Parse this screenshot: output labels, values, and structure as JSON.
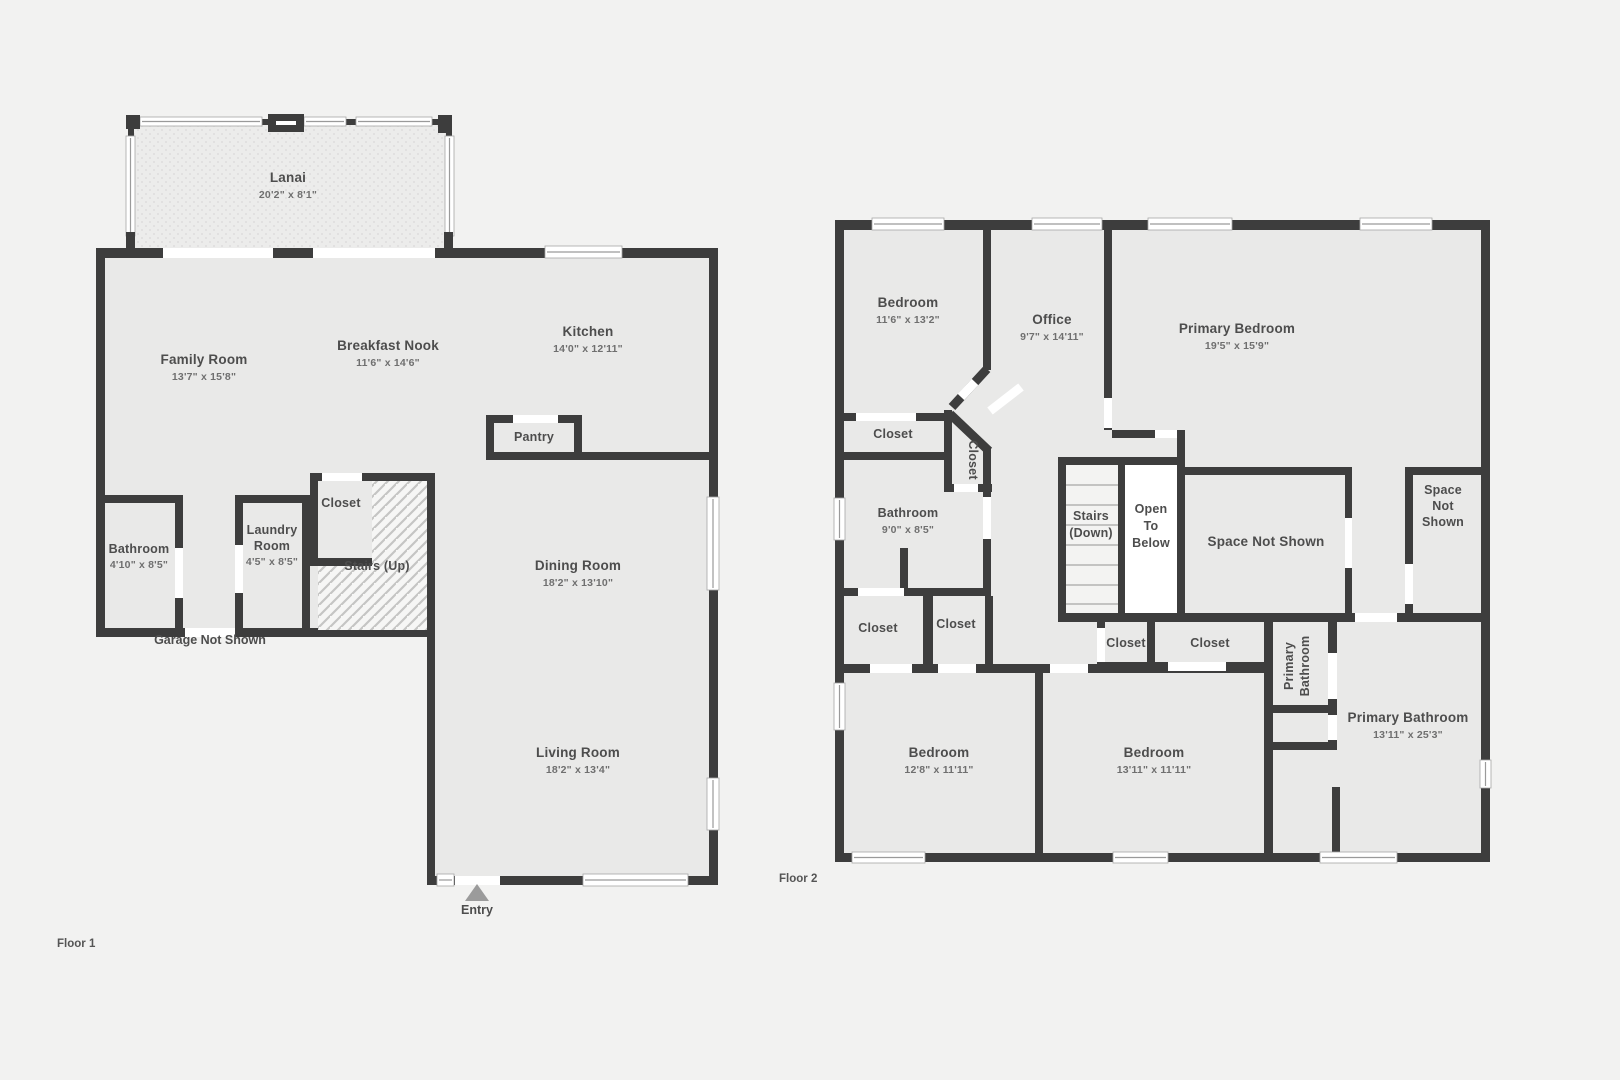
{
  "colors": {
    "background": "#f2f2f1",
    "room_fill": "#e9e9e8",
    "wall": "#3d3d3d",
    "label_text": "#4d4d4d",
    "dim_text": "#6f6f6f",
    "entry_marker": "#9b9b9b"
  },
  "floor1": {
    "title": "Floor 1",
    "lanai": {
      "name": "Lanai",
      "dims": "20'2\" x 8'1\""
    },
    "family_room": {
      "name": "Family Room",
      "dims": "13'7\" x 15'8\""
    },
    "breakfast_nook": {
      "name": "Breakfast Nook",
      "dims": "11'6\" x 14'6\""
    },
    "kitchen": {
      "name": "Kitchen",
      "dims": "14'0\" x 12'11\""
    },
    "pantry": {
      "name": "Pantry"
    },
    "bathroom": {
      "name": "Bathroom",
      "dims": "4'10\" x 8'5\""
    },
    "laundry_room": {
      "name": "Laundry Room",
      "line1": "Laundry",
      "line2": "Room",
      "dims": "4'5\" x 8'5\""
    },
    "closet": {
      "name": "Closet"
    },
    "stairs": {
      "name": "Stairs (Up)"
    },
    "dining_room": {
      "name": "Dining Room",
      "dims": "18'2\" x 13'10\""
    },
    "living_room": {
      "name": "Living Room",
      "dims": "18'2\" x 13'4\""
    },
    "garage_note": "Garage Not Shown",
    "entry_label": "Entry"
  },
  "floor2": {
    "title": "Floor 2",
    "bedroom_1": {
      "name": "Bedroom",
      "dims": "11'6\" x 13'2\""
    },
    "office": {
      "name": "Office",
      "dims": "9'7\" x 14'11\""
    },
    "primary_bedroom": {
      "name": "Primary Bedroom",
      "dims": "19'5\" x 15'9\""
    },
    "bedroom_closet": {
      "name": "Closet"
    },
    "angled_closet": {
      "name": "Closet"
    },
    "bathroom": {
      "name": "Bathroom",
      "dims": "9'0\" x 8'5\""
    },
    "stairs": {
      "line1": "Stairs",
      "line2": "(Down)"
    },
    "open_to_below": {
      "line1": "Open",
      "line2": "To",
      "line3": "Below"
    },
    "space_not_shown_center": {
      "name": "Space Not Shown"
    },
    "space_not_shown_right": {
      "line1": "Space",
      "line2": "Not",
      "line3": "Shown"
    },
    "closet_a": {
      "name": "Closet"
    },
    "closet_b": {
      "name": "Closet"
    },
    "closet_c": {
      "name": "Closet"
    },
    "closet_d": {
      "name": "Closet"
    },
    "primary_bath_vertical": {
      "line1": "Primary",
      "line2": "Bathroom"
    },
    "primary_bathroom": {
      "name": "Primary Bathroom",
      "dims": "13'11\" x 25'3\""
    },
    "bedroom_2": {
      "name": "Bedroom",
      "dims": "12'8\" x 11'11\""
    },
    "bedroom_3": {
      "name": "Bedroom",
      "dims": "13'11\" x 11'11\""
    }
  }
}
